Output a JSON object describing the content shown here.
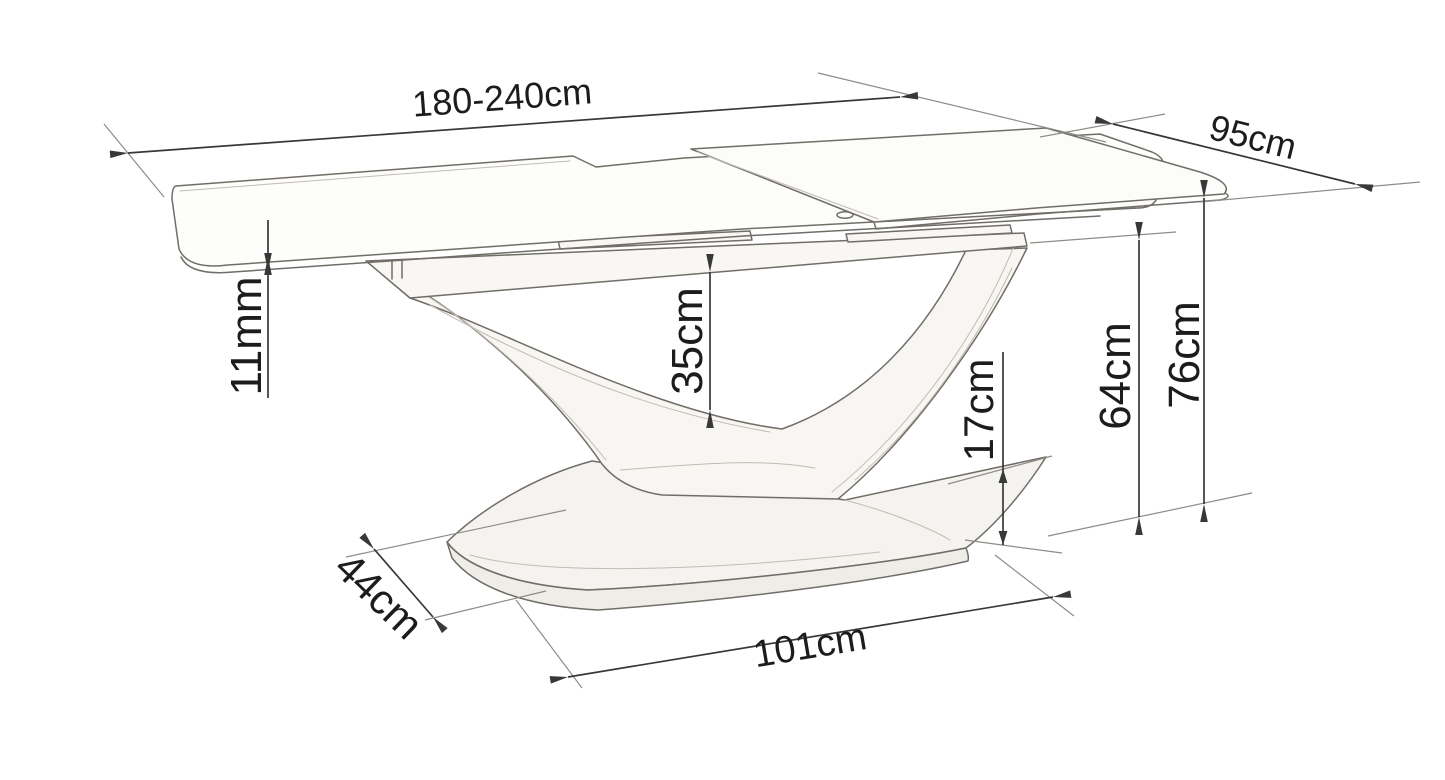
{
  "diagram": {
    "description": "Line-art dimension drawing of an extendable dining table with a curved V-shaped pedestal on an oval plinth base",
    "colors": {
      "background": "#ffffff",
      "dimension_lines": "#383838",
      "sketch_outline": "#716e68",
      "label_text": "#1c1c1c",
      "shading": "#f5f3ef"
    }
  },
  "labels": {
    "length": "180-240cm",
    "depth": "95cm",
    "top_thickness": "11mm",
    "under_clearance": "35cm",
    "base_height": "17cm",
    "frame_height": "64cm",
    "total_height": "76cm",
    "base_depth": "44cm",
    "base_length": "101cm"
  }
}
